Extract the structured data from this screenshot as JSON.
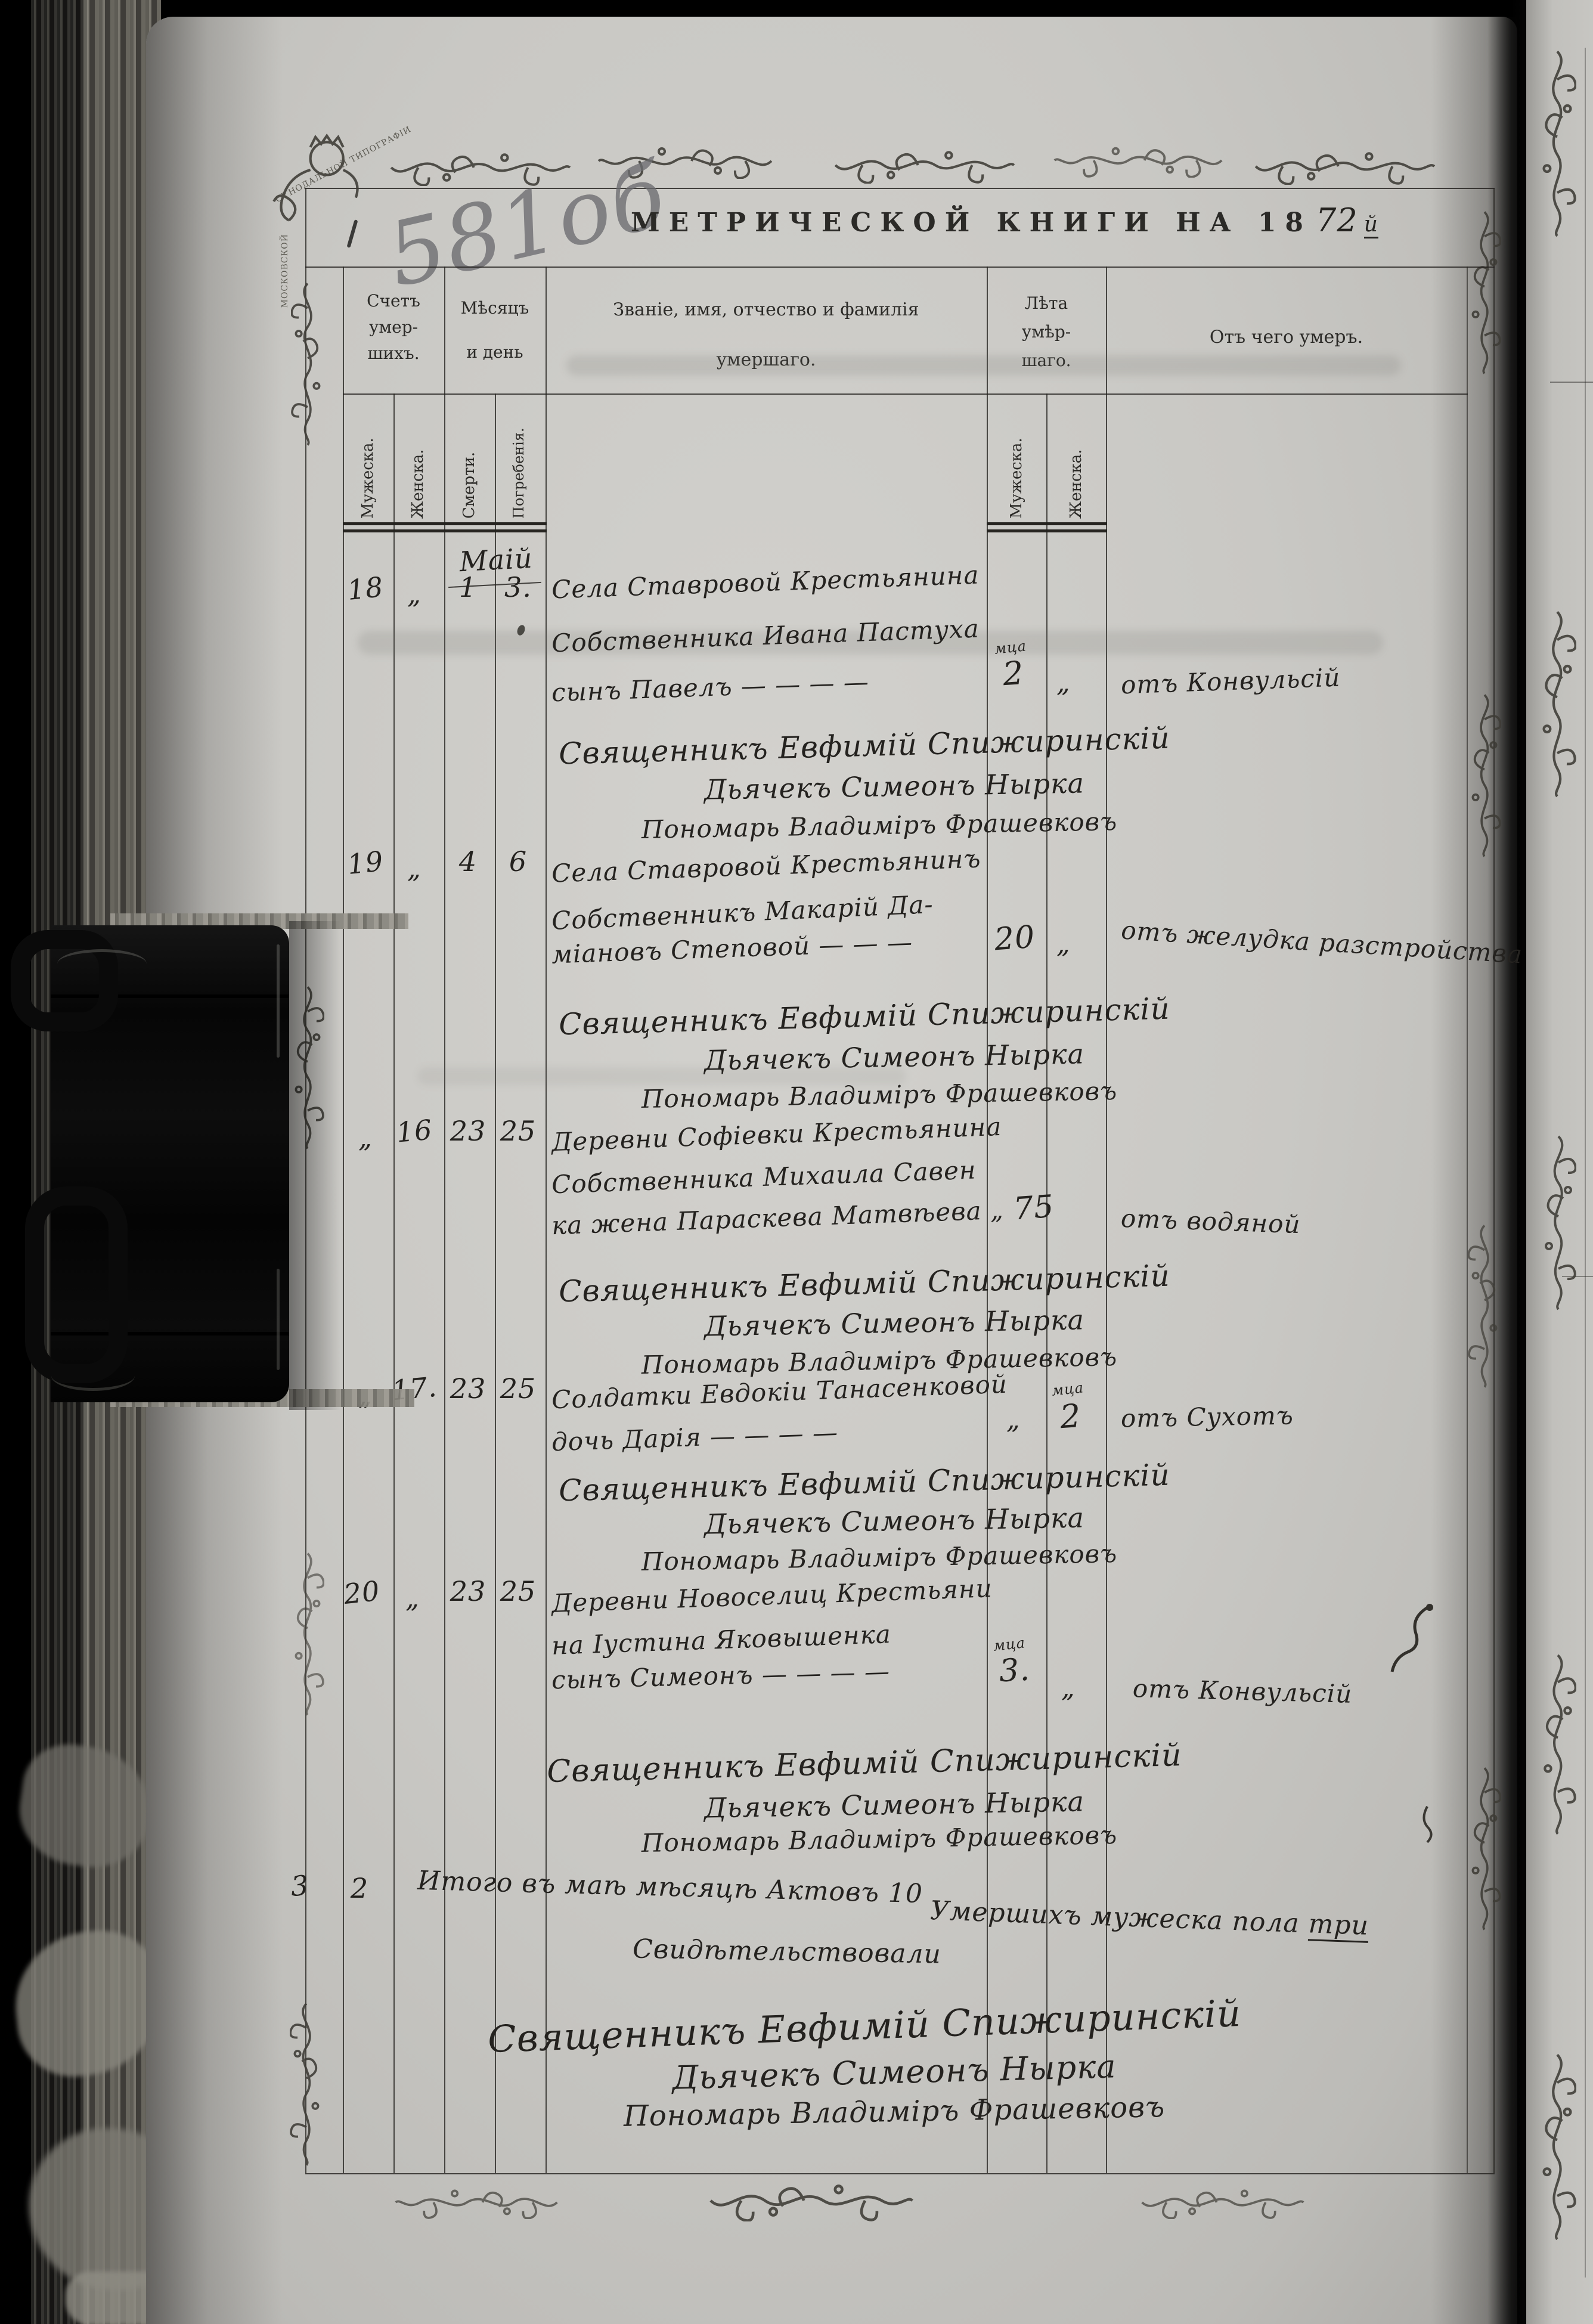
{
  "page": {
    "pencil_number": "581об",
    "title_prefix": "МЕТРИЧЕСКОЙ КНИГИ НА 18",
    "title_year": "72",
    "title_year_suffix": "й"
  },
  "ornament_ribbon": {
    "top": "СѴНОДАЛЬНОЙ ТИПОГРАФІИ",
    "left": "МОСКОВСКОЙ"
  },
  "table": {
    "headers": {
      "count_group": [
        "Счетъ",
        "умер-",
        "шихъ."
      ],
      "month_group": [
        "Мѣсяцъ",
        "и день"
      ],
      "name_group": [
        "Званіе, имя, отчество и фамилія",
        "умершаго."
      ],
      "age_group": [
        "Лѣта",
        "умѣр-",
        "шаго."
      ],
      "cause_group": "Отъ чего умеръ.",
      "sub": {
        "male": "Мужеска.",
        "female": "Женска.",
        "death": "Смерти.",
        "burial": "Погребенія.",
        "age_male": "Мужеска.",
        "age_female": "Женска."
      }
    },
    "month_label": "Маій",
    "entries": [
      {
        "no_m": "18",
        "no_f": "„",
        "death": "1",
        "burial": "3.",
        "lines": [
          "Села Ставровой Крестьянина",
          "Собственника Ивана Пастуха",
          "сынъ Павелъ  —  —  —  —"
        ],
        "age_unit": "мца",
        "age_m": "2",
        "age_f": "„",
        "cause": "отъ Конвульсій"
      },
      {
        "no_m": "19",
        "no_f": "„",
        "death": "4",
        "burial": "6",
        "lines": [
          "Села Ставровой Крестьянинъ",
          "Собственникъ Макарій Да-",
          "міановъ Степовой  —  —  —"
        ],
        "age_m": "20",
        "age_f": "„",
        "cause": "отъ желудка разстройства"
      },
      {
        "no_m": "„",
        "no_f": "16",
        "death": "23",
        "burial": "25",
        "lines": [
          "Деревни Софіевки Крестьянина",
          "Собственника Михаила Савен",
          "ка жена Параскева Матвѣева „"
        ],
        "age_f": "75",
        "cause": "отъ водяной"
      },
      {
        "no_m": "„",
        "no_f": "17.",
        "death": "23",
        "burial": "25",
        "lines": [
          "Солдатки Евдокіи Танасенковой",
          "дочь Дарія  —  —  —  —"
        ],
        "age_unit": "мца",
        "age_m": "„",
        "age_f": "2",
        "cause": "отъ Сухотъ"
      },
      {
        "no_m": "20",
        "no_f": "„",
        "death": "23",
        "burial": "25",
        "lines": [
          "Деревни Новоселиц Крестьяни",
          "на Іустина Яковышенка",
          "сынъ Симеонъ  —  —  —  —"
        ],
        "age_unit": "мца",
        "age_m": "3.",
        "age_f": "„",
        "cause": "отъ Конвульсій"
      }
    ],
    "clergy": {
      "priest": "Священникъ Евфимій Спижиринскій",
      "deacon": "Дьячекъ Симеонъ Нырка",
      "sexton": "Пономарь Владиміръ Фрашевковъ"
    },
    "summary": {
      "male_total": "3",
      "female_total": "2",
      "line1": "Итого въ маѣ мѣсяцѣ Актовъ 10",
      "line2_prefix": "Умершихъ мужеска пола ",
      "line2_underlined": "три",
      "line3": "Свидѣтельствовали"
    }
  }
}
